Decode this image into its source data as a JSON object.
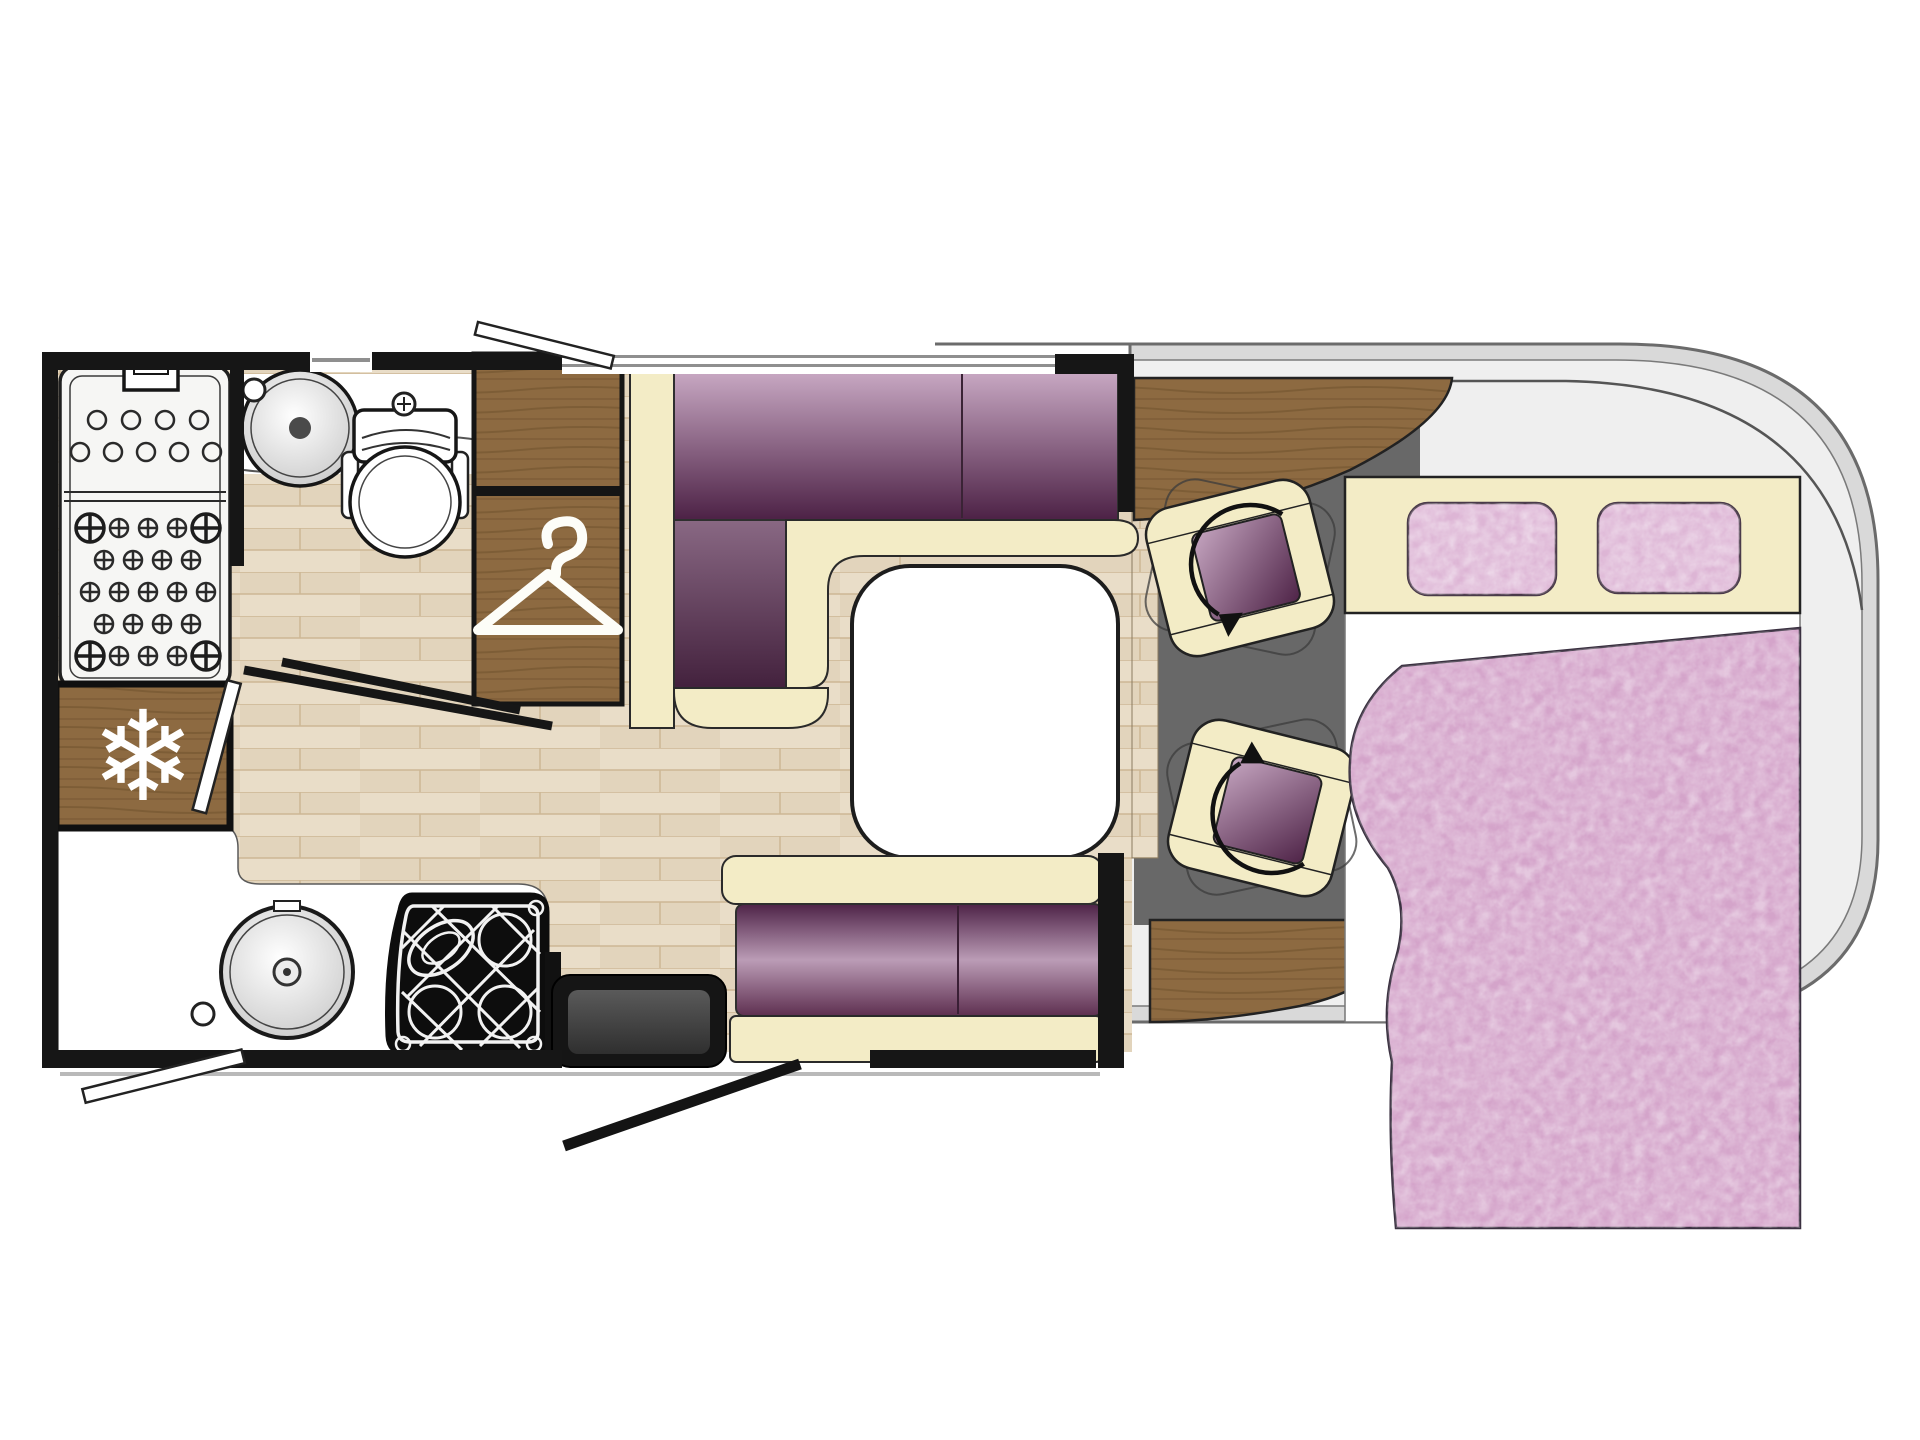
{
  "meta": {
    "title": "Motorhome Floor Plan",
    "type": "vehicle-floorplan-diagram"
  },
  "colors": {
    "background": "#ffffff",
    "wall": "#161616",
    "body_band": "#d9d9d9",
    "body_stroke": "#6b6b6b",
    "body_interior": "#efefef",
    "floor_base": "#e9ddc8",
    "floor_shade": "#e2d4bc",
    "floor_line": "#cdb795",
    "wood": "#8d6a41",
    "wood_grain": "#5f4523",
    "cream": "#f3ecc6",
    "outline": "#2b2b2b",
    "purple_light": "#c6a6c1",
    "purple_dark": "#4e2347",
    "bench_mid": "#bb9cb6",
    "grey_floor": "#686868",
    "duvet_pink": "#d4a4ca",
    "pillow_pink": "#ddb5d5",
    "white": "#ffffff",
    "appliance_black": "#0d0d0d",
    "step_grey": "#464646",
    "window_line": "#8f8f8f"
  },
  "icons": {
    "snowflake_glyph": "❄",
    "fridge_icon": "snowflake-icon",
    "wardrobe_icon": "clothes-hanger-icon",
    "swivel_icon": "rotation-arrow-icon"
  },
  "rooms": [
    {
      "name": "washroom",
      "fixtures": [
        "shower-tray",
        "wash-basin",
        "toilet",
        "folding-door"
      ]
    },
    {
      "name": "kitchen",
      "fixtures": [
        "refrigerator",
        "round-sink",
        "gas-hob-3-burner",
        "worktop"
      ]
    },
    {
      "name": "lounge-dinette",
      "fixtures": [
        "l-shaped-sofa",
        "side-bench",
        "pedestal-table",
        "wardrobe"
      ]
    },
    {
      "name": "cab",
      "fixtures": [
        "swivel-seat",
        "swivel-seat",
        "dashboard-counter",
        "rear-counter"
      ]
    },
    {
      "name": "bedroom",
      "fixtures": [
        "double-bed",
        "pillow",
        "pillow",
        "duvet",
        "overcab-shelf"
      ]
    }
  ],
  "entrances": [
    "habitation-door-with-step",
    "top-window-flap",
    "bottom-window-flap"
  ]
}
